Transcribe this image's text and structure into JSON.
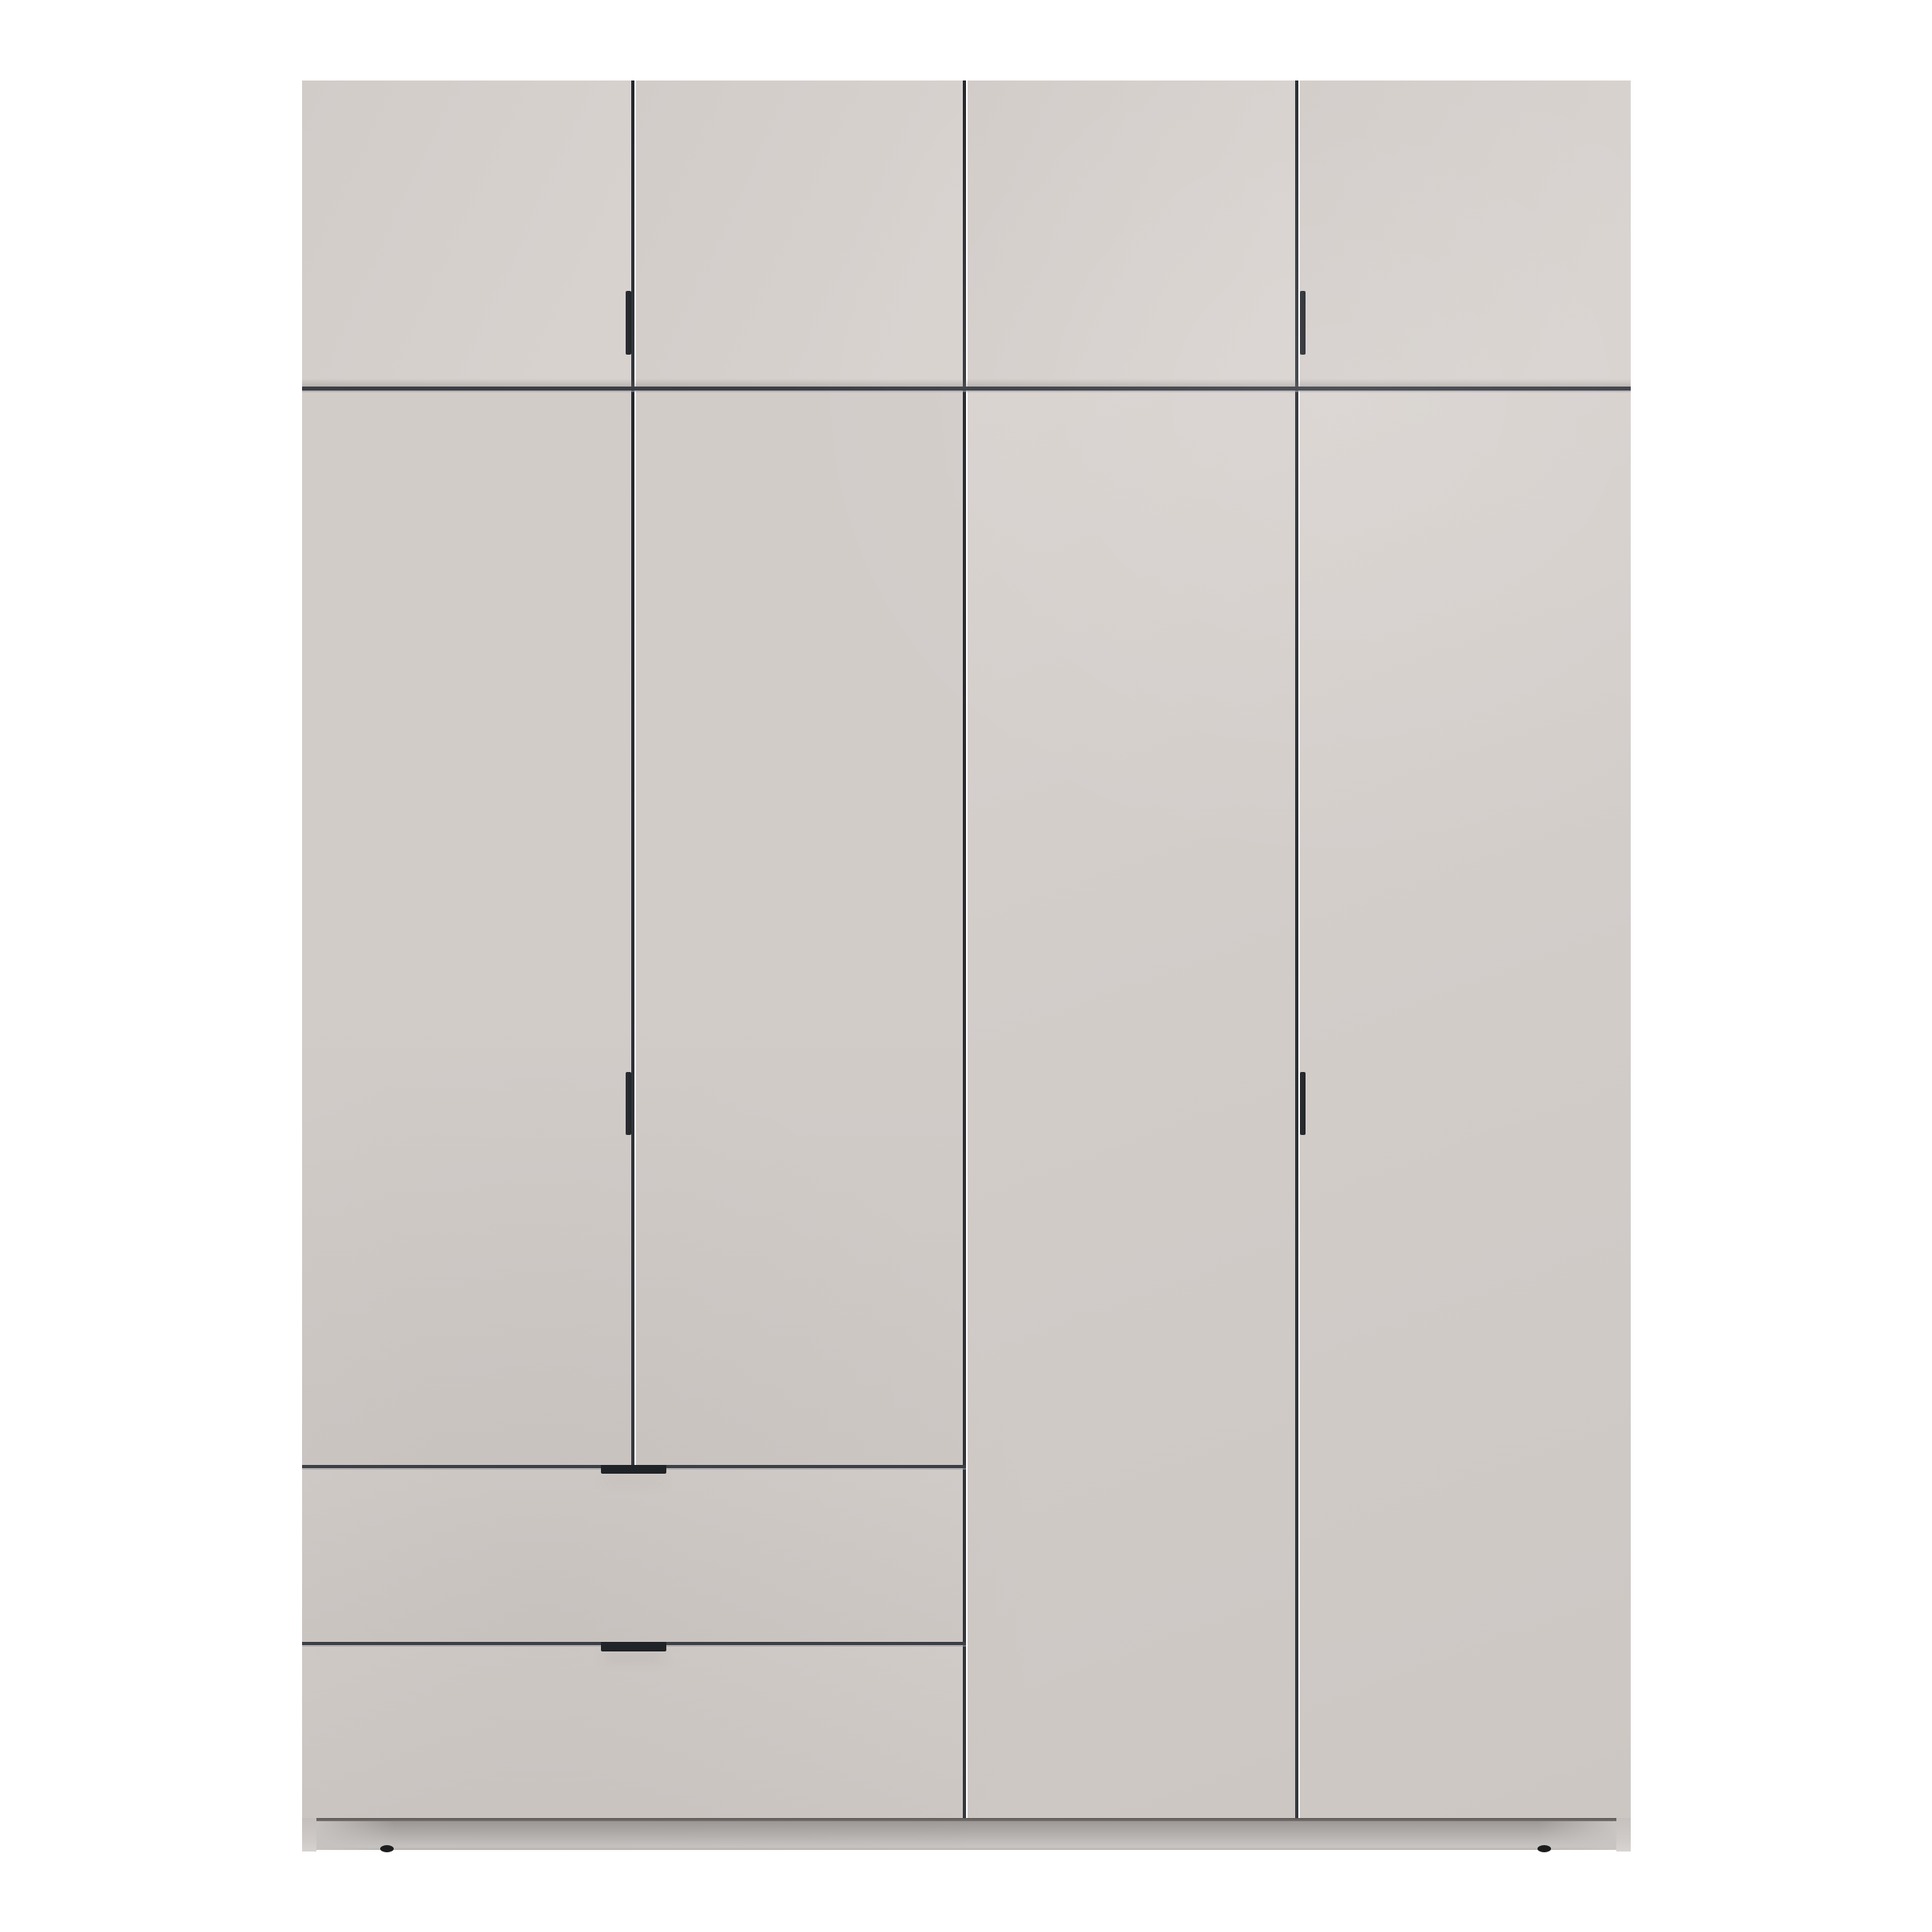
{
  "scene": {
    "description": "Studio product photo of a tall four-door wardrobe on a plain white background",
    "background_color": "#ffffff"
  },
  "wardrobe": {
    "label": "Four-door wardrobe with top cabinet row and two drawers",
    "top_cabinet_doors": 4,
    "main_doors": 4,
    "drawers": 2,
    "vertical_bar_handles": 4,
    "drawer_tab_handles": 2,
    "feet_visible": 2
  },
  "parts": {
    "wardrobe": "wardrobe cabinet",
    "top_door_1": "top cabinet door 1",
    "top_door_2": "top cabinet door 2",
    "top_door_3": "top cabinet door 3",
    "top_door_4": "top cabinet door 4",
    "main_door_1": "left wardrobe door 1",
    "main_door_2": "left wardrobe door 2",
    "main_door_3": "right wardrobe door 3",
    "main_door_4": "right wardrobe door 4",
    "drawer_1": "upper drawer",
    "drawer_2": "lower drawer",
    "handle_top_left": "top left door handle",
    "handle_top_right": "top right door handle",
    "handle_mid_left": "left door handle",
    "handle_mid_right": "right door handle",
    "handle_drawer_1": "upper drawer handle",
    "handle_drawer_2": "lower drawer handle",
    "plinth": "plinth base",
    "foot_left": "left foot",
    "foot_right": "right foot"
  },
  "colors": {
    "background": "#ffffff",
    "door_face": "#d2ccc9",
    "door_face_light": "#d8d2cf",
    "door_face_dark": "#cdc7c4",
    "gap_vertical": "#24272b",
    "gap_horizontal": "#3b3f45",
    "gap_highlight": "#9a9da2",
    "handle": "#22252a",
    "drawer_handle": "#1e2125",
    "plinth_dark": "#9d9997",
    "plinth_light": "#c9c5c3",
    "strip": "#cfcac7",
    "foot": "#1c1c1c",
    "shadow_soft": "#6e6864"
  }
}
